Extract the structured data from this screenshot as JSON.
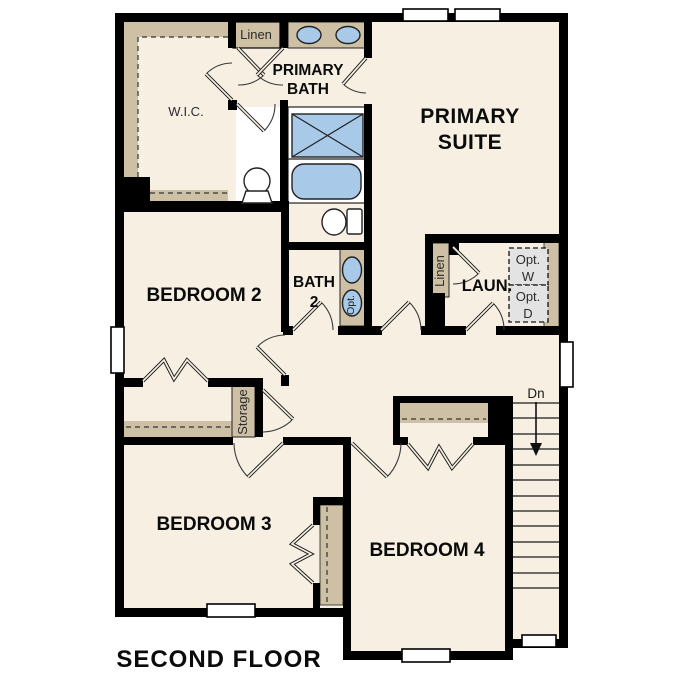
{
  "plan": {
    "title": "SECOND FLOOR",
    "labels": {
      "wic": "W.I.C.",
      "linen_top": "Linen",
      "primary_bath_1": "PRIMARY",
      "primary_bath_2": "BATH",
      "primary_suite_1": "PRIMARY",
      "primary_suite_2": "SUITE",
      "bedroom2": "BEDROOM 2",
      "bath2_1": "BATH",
      "bath2_2": "2",
      "opt_sink": "Opt.",
      "linen_laundry": "Linen",
      "laundry": "LAUN.",
      "opt_w_1": "Opt.",
      "opt_w_2": "W",
      "opt_d_1": "Opt.",
      "opt_d_2": "D",
      "storage": "Storage",
      "bedroom3": "BEDROOM 3",
      "bedroom4": "BEDROOM 4",
      "stairs_down": "Dn"
    },
    "colors": {
      "background": "#ffffff",
      "floor": "#f6efe2",
      "walls": "#000000",
      "shelf_tan": "#cdc0a5",
      "fixture_blue": "#a9c9e9",
      "optional_gray": "#e3e3e3"
    }
  }
}
